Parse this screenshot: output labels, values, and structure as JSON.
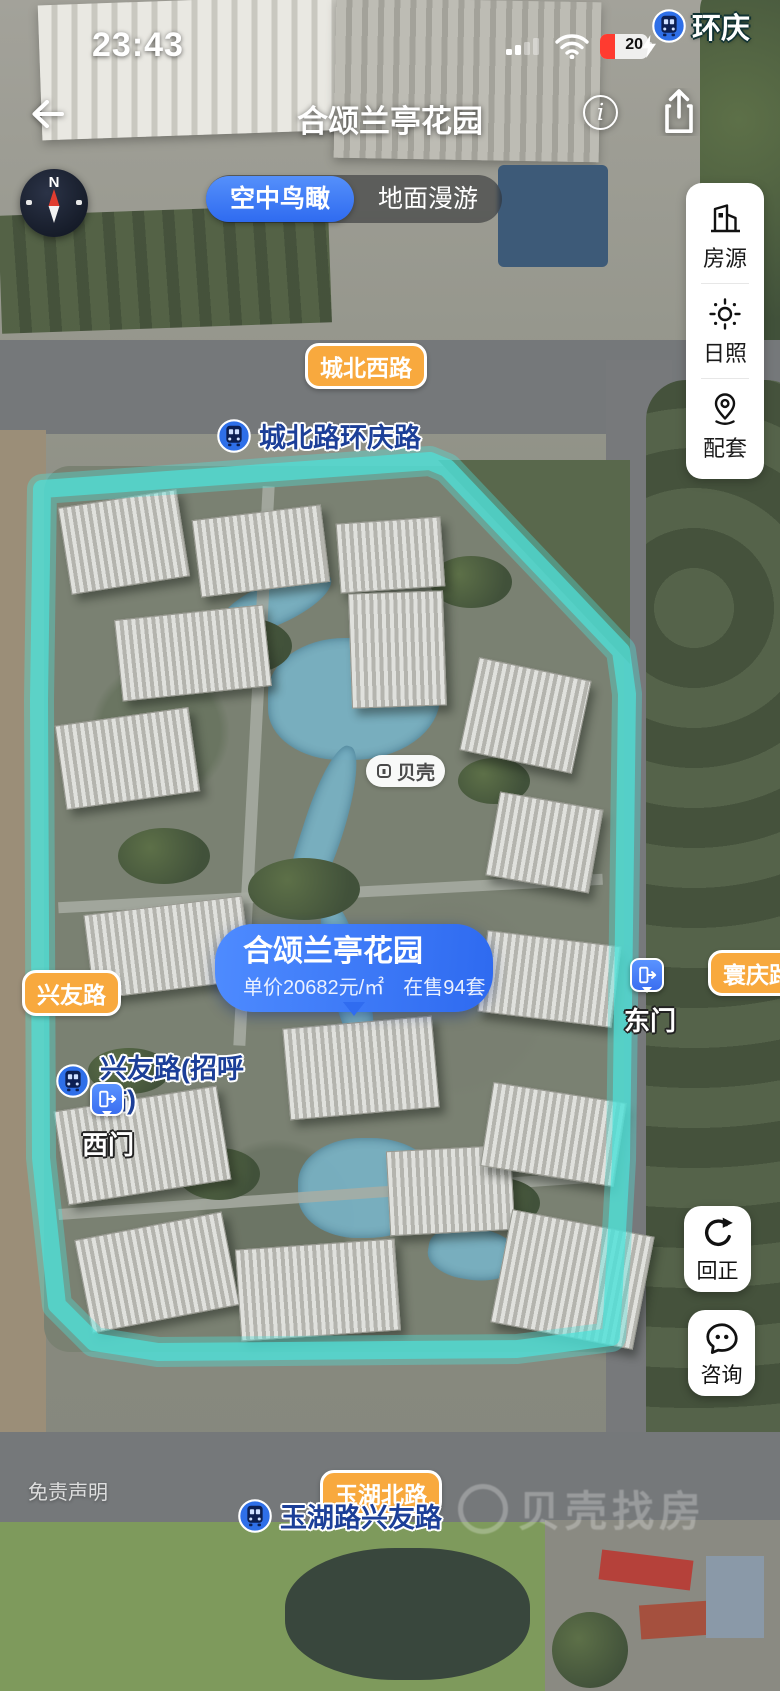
{
  "status_bar": {
    "time": "23:43",
    "battery_level": "20"
  },
  "corner_station": {
    "label": "环庆"
  },
  "header": {
    "title": "合颂兰亭花园"
  },
  "compass": {
    "north": "N"
  },
  "view_toggle": {
    "selected": "空中鸟瞰",
    "options": [
      {
        "label": "空中鸟瞰"
      },
      {
        "label": "地面漫游"
      }
    ]
  },
  "side_tools": {
    "items": [
      {
        "icon": "building-icon",
        "label": "房源"
      },
      {
        "icon": "sun-icon",
        "label": "日照"
      },
      {
        "icon": "map-pin-icon",
        "label": "配套"
      }
    ]
  },
  "roads": {
    "north": "城北西路",
    "west": "兴友路",
    "east": "寰庆路",
    "south": "玉湖北路"
  },
  "metro_stations": {
    "north": "城北路环庆路",
    "west": "兴友路(招呼站)",
    "south": "玉湖路兴友路"
  },
  "gates": {
    "east": "东门",
    "west": "西门"
  },
  "property_bubble": {
    "name": "合颂兰亭花园",
    "price": "单价20682元/㎡",
    "stock": "在售94套"
  },
  "map_badge": {
    "label": "贝壳"
  },
  "map_tools": {
    "reset": "回正",
    "consult": "咨询"
  },
  "footer": {
    "disclaimer": "免责声明",
    "watermark": "贝壳找房"
  },
  "colors": {
    "accent_blue": "#3b78f2",
    "road_label_orange": "#f8a93e",
    "boundary_teal": "#4fe0d8",
    "metro_blue": "#2e6fe8"
  }
}
